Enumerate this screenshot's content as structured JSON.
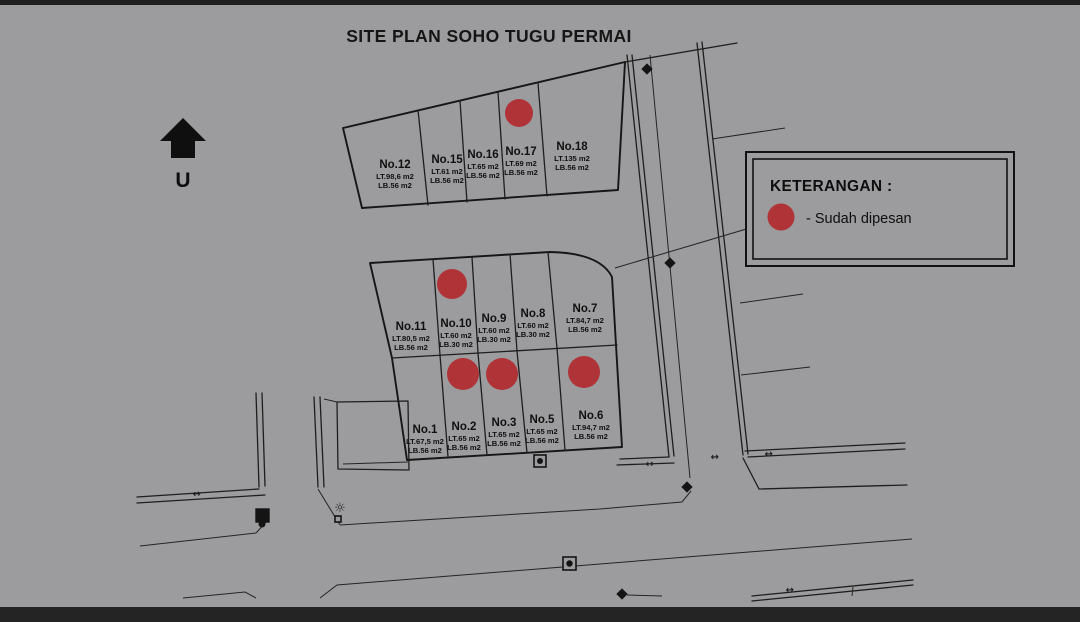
{
  "title": "SITE PLAN SOHO TUGU PERMAI",
  "north": {
    "label": "U"
  },
  "legend": {
    "title": "KETERANGAN :",
    "item_label": "- Sudah dipesan",
    "marker": "red-circle"
  },
  "colors": {
    "background": "#9c9c9e",
    "line": "#1e1e1e",
    "reserved_marker": "#b03338"
  },
  "plots": [
    {
      "no": "No.12",
      "lt": "LT.98,6 m2",
      "lb": "LB.56 m2",
      "reserved": false
    },
    {
      "no": "No.15",
      "lt": "LT.61 m2",
      "lb": "LB.56 m2",
      "reserved": false
    },
    {
      "no": "No.16",
      "lt": "LT.65 m2",
      "lb": "LB.56 m2",
      "reserved": false
    },
    {
      "no": "No.17",
      "lt": "LT.69 m2",
      "lb": "LB.56 m2",
      "reserved": true
    },
    {
      "no": "No.18",
      "lt": "LT.135 m2",
      "lb": "LB.56 m2",
      "reserved": false
    },
    {
      "no": "No.11",
      "lt": "LT.80,5 m2",
      "lb": "LB.56 m2",
      "reserved": false
    },
    {
      "no": "No.10",
      "lt": "LT.60 m2",
      "lb": "LB.30 m2",
      "reserved": true
    },
    {
      "no": "No.9",
      "lt": "LT.60 m2",
      "lb": "LB.30 m2",
      "reserved": false
    },
    {
      "no": "No.8",
      "lt": "LT.60 m2",
      "lb": "LB.30 m2",
      "reserved": false
    },
    {
      "no": "No.7",
      "lt": "LT.84,7 m2",
      "lb": "LB.56 m2",
      "reserved": false
    },
    {
      "no": "No.1",
      "lt": "LT.67,5 m2",
      "lb": "LB.56 m2",
      "reserved": false
    },
    {
      "no": "No.2",
      "lt": "LT.65 m2",
      "lb": "LB.56 m2",
      "reserved": true
    },
    {
      "no": "No.3",
      "lt": "LT.65 m2",
      "lb": "LB.56 m2",
      "reserved": true
    },
    {
      "no": "No.5",
      "lt": "LT.65 m2",
      "lb": "LB.56 m2",
      "reserved": false
    },
    {
      "no": "No.6",
      "lt": "LT.94,7 m2",
      "lb": "LB.56 m2",
      "reserved": true
    }
  ],
  "reserved_plot_numbers": [
    "No.17",
    "No.10",
    "No.2",
    "No.3",
    "No.6"
  ]
}
